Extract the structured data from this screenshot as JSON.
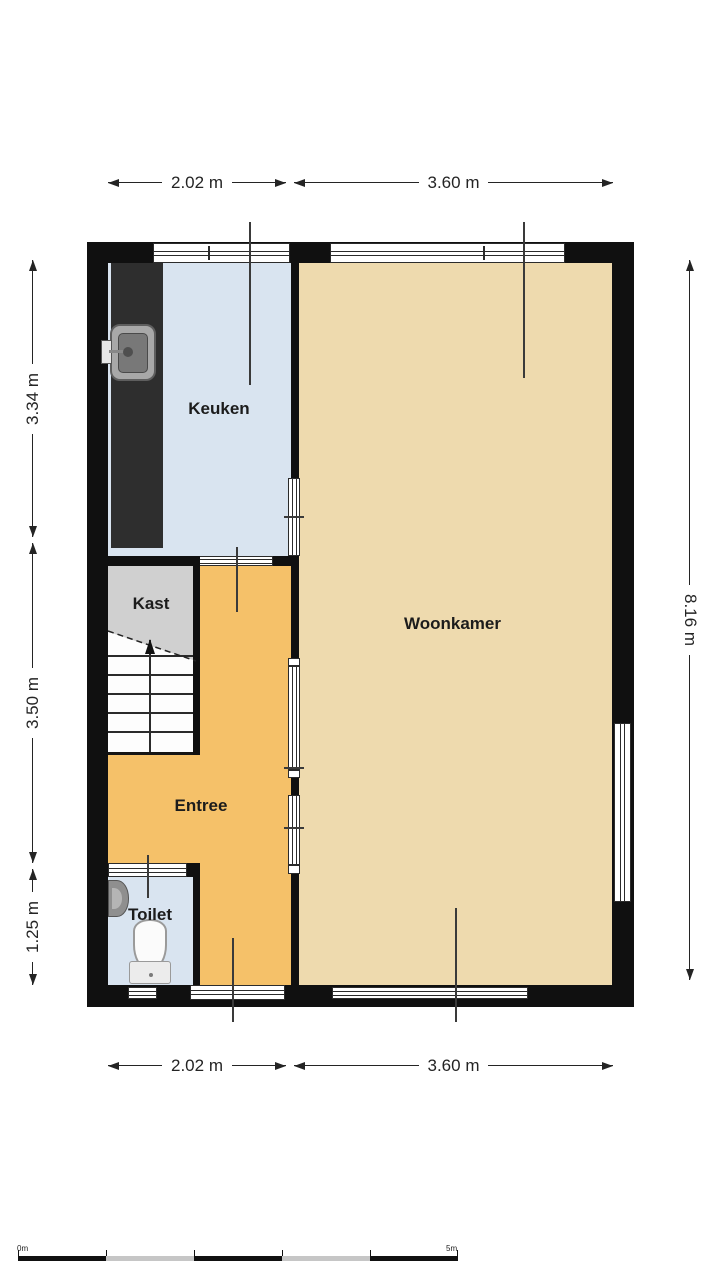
{
  "plan": {
    "type": "floorplan",
    "rooms": {
      "keuken": {
        "label": "Keuken"
      },
      "woonkamer": {
        "label": "Woonkamer"
      },
      "kast": {
        "label": "Kast"
      },
      "entree": {
        "label": "Entree"
      },
      "toilet": {
        "label": "Toilet"
      }
    },
    "icons": {
      "kitchen_sink": "sink-icon",
      "hand_basin": "hand-basin-icon",
      "toilet": "toilet-icon",
      "stairs_direction": "stairs-up-arrow-icon"
    }
  },
  "dimensions": {
    "top": [
      {
        "label": "2.02 m"
      },
      {
        "label": "3.60 m"
      }
    ],
    "bottom": [
      {
        "label": "2.02 m"
      },
      {
        "label": "3.60 m"
      }
    ],
    "left": [
      {
        "label": "3.34 m"
      },
      {
        "label": "3.50 m"
      },
      {
        "label": "1.25 m"
      }
    ],
    "right": [
      {
        "label": "8.16 m"
      }
    ]
  },
  "scale_bar": {
    "start_label": "0m",
    "end_label": "5m"
  },
  "colors": {
    "wall": "#101010",
    "keuken_floor": "#d9e4f0",
    "toilet_floor": "#d9e4f0",
    "woonkamer_floor": "#eedaae",
    "entree_floor": "#f5c169",
    "kast_floor": "#d0d0d0",
    "counter": "#2e2e2e",
    "stairs": "#fdfdfd"
  }
}
